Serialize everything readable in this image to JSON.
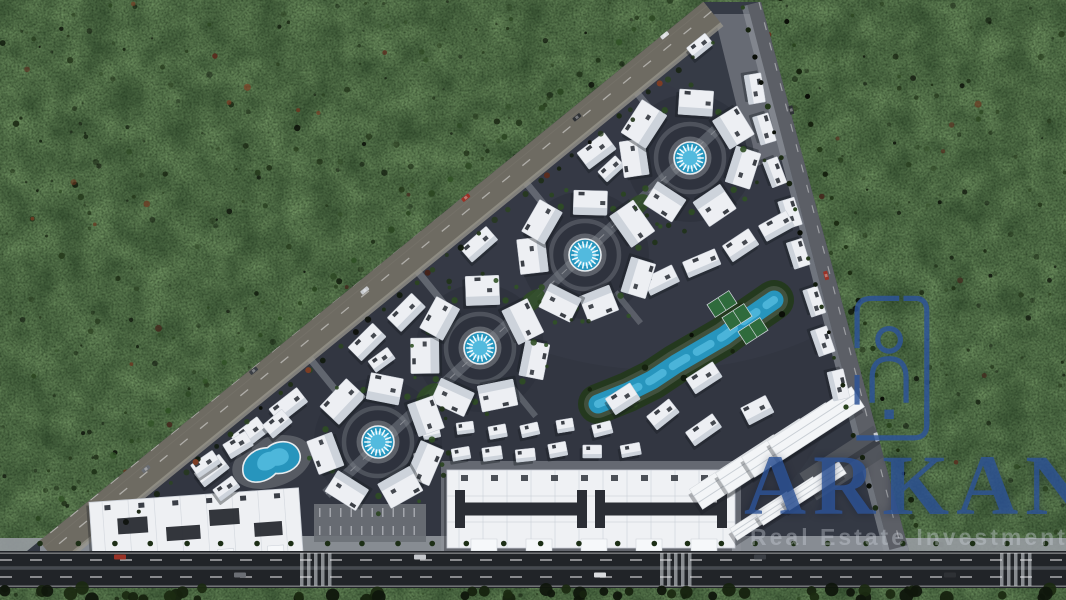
{
  "meta": {
    "description": "Aerial 3D render of a triangular residential compound master plan surrounded by dense dark forest, with a highway along the bottom edge"
  },
  "watermark": {
    "brand": "ARKAN",
    "tagline": "Real Estate Investment",
    "brand_color": "#2d5498",
    "logo": "arkan-building-logo"
  },
  "palette": {
    "forest_base": "#0c110a",
    "forest_tones": [
      "#16220f",
      "#1d2d14",
      "#0a0e07",
      "#24381a",
      "#101a0c",
      "#2b4520"
    ],
    "forest_red": [
      "#5a2c1e",
      "#6e351f",
      "#44221a",
      "#7c3d24"
    ],
    "ground": "#343944",
    "road_hyp": "#6e6b62",
    "road_gray": "#5c5f66",
    "road_edge": "#8e8b80",
    "sidewalk": "#979ba1",
    "plaza": "#8f949b",
    "bldg": "#edeff3",
    "bldg_shade": "#c2c9d3",
    "bldg_stroke": "#c9ced6",
    "bldg_dark": "#272b33",
    "shadow": "#161a20",
    "pool": "#2795bd",
    "pool_light": "#52bade",
    "pool_deck": "#8b9096",
    "green": "#24391c",
    "green_light": "#2f4d24",
    "court": "#2f6b3c",
    "asphalt": "#212428",
    "canopy": "#f3f5f7",
    "gray_bldg": "#51555c"
  },
  "scene": {
    "site": [
      [
        703,
        2
      ],
      [
        761,
        2
      ],
      [
        909,
        551
      ],
      [
        27,
        551
      ]
    ],
    "hyp_road": [
      707,
      6,
      44,
      547,
      46
    ],
    "right_road": [
      759,
      2,
      901,
      547,
      24
    ],
    "spine": [
      716,
      130,
      326,
      494
    ],
    "pools": [
      [
        690,
        158
      ],
      [
        585,
        255
      ],
      [
        480,
        348
      ],
      [
        378,
        442
      ]
    ],
    "ring": {
      "pool_r": 16,
      "ring_r": 54,
      "count": 7,
      "bw": 36,
      "bh": 27
    },
    "kidney": [
      272,
      462,
      -18
    ],
    "river": [
      [
        598,
        404
      ],
      [
        628,
        392
      ],
      [
        652,
        380
      ],
      [
        676,
        364
      ],
      [
        700,
        350
      ],
      [
        724,
        336
      ],
      [
        748,
        318
      ],
      [
        774,
        300
      ]
    ],
    "courts": [
      [
        737,
        317
      ],
      [
        753,
        331
      ],
      [
        722,
        304
      ]
    ],
    "rows": [
      [
        676,
        88,
        210,
        468,
        13,
        34,
        19,
        -39.5,
        1
      ],
      [
        753,
        86,
        836,
        384,
        8,
        29,
        16,
        75,
        0
      ],
      [
        664,
        282,
        776,
        224,
        4,
        33,
        18,
        -28,
        0
      ],
      [
        624,
        400,
        704,
        432,
        3,
        31,
        18,
        -33,
        0
      ],
      [
        424,
        458,
        628,
        448,
        7,
        19,
        13,
        -6,
        0
      ],
      [
        430,
        432,
        600,
        426,
        6,
        18,
        12,
        -10,
        0
      ],
      [
        206,
        466,
        276,
        422,
        3,
        27,
        16,
        -36,
        0
      ],
      [
        706,
        380,
        760,
        408,
        2,
        30,
        18,
        -30,
        0
      ]
    ],
    "extra_buildings": [
      [
        700,
        46,
        24,
        14,
        -39
      ]
    ],
    "commercial1": [
      196,
      527,
      -4
    ],
    "commercial2": [
      591,
      509,
      0
    ],
    "canopiesA": [
      738,
      472,
      26,
      -16,
      4,
      100,
      24,
      -33
    ],
    "canopyGray": [
      845,
      463,
      88,
      32,
      -33
    ],
    "canopiesB": [
      762,
      516,
      26,
      -15,
      3,
      68,
      14,
      -33
    ],
    "parking": [
      314,
      504,
      112,
      38
    ],
    "highway": {
      "side_top": 538,
      "road_top": 551,
      "road_bot": 588,
      "dash_y": [
        560,
        577
      ],
      "median_y": 568,
      "crosswalks": [
        300,
        660,
        1000
      ]
    },
    "plaza_apex": [
      [
        714,
        14
      ],
      [
        756,
        14
      ],
      [
        798,
        150
      ],
      [
        752,
        168
      ]
    ],
    "green_patches": [
      [
        637,
        206
      ],
      [
        532,
        301
      ],
      [
        429,
        395
      ]
    ]
  }
}
